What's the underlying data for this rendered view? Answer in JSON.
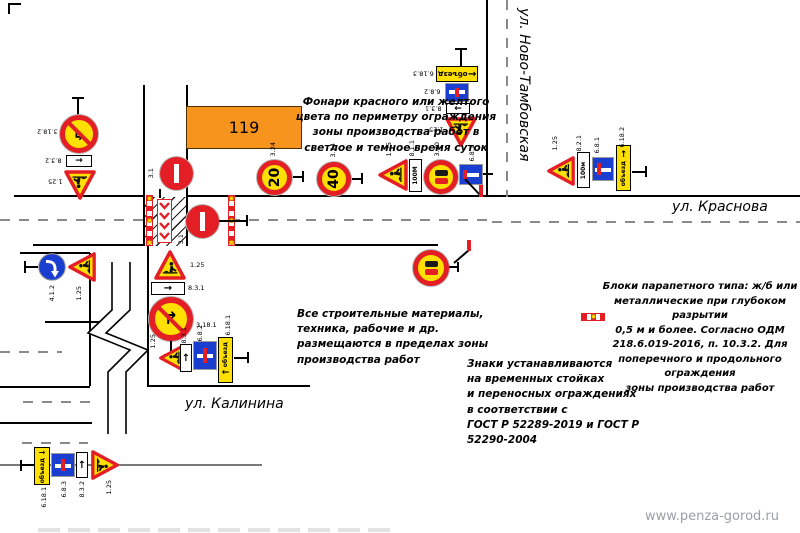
{
  "streets": {
    "vertical_right": "ул. Ново-Тамбовская",
    "horizontal_right": "ул. Краснова",
    "bottom_left": "ул. Калинина"
  },
  "building": {
    "label": "119"
  },
  "notes": {
    "lamps": "Фонари красного или желтого\nцвета по периметру ограждения\nзоны производства работ в\nсветлое и темное время суток",
    "materials": "Все строительные материалы,\nтехника, рабочие и др.\nразмещаются в пределах зоны\nпроизводства работ",
    "mounting": "Знаки устанавливаются\nна временных стойках\nи переносных ограждениях\nв соответствии с\nГОСТ Р 52289-2019 и ГОСТ Р\n52290-2004",
    "parapet": "Блоки парапетного типа: ж/б или\nметаллические при глубоком разрытии\n0,5 м и более. Согласно ОДМ\n218.6.019-2016, п. 10.3.2. Для\nпоперечного и продольного ограждения\nзоны производства работ"
  },
  "signs": {
    "speed20": "20",
    "speed40": "40",
    "dist_100m_upper": "100М",
    "dist_100m_lower": "100м",
    "detour_text": "объезд",
    "labels": {
      "g_topleft": [
        "3.18.2",
        "8.3.2",
        "1.25"
      ],
      "g_top": [
        "6.18.3",
        "6.8.2",
        "8.3.1",
        "1.25"
      ],
      "row": [
        "3.24",
        "3.24",
        "1.25",
        "8.1.1",
        "3.20",
        "6.8.1"
      ],
      "g_right": [
        "1.25",
        "8.2.1",
        "6.8.1",
        "6.18.2"
      ],
      "workzone": [
        "3.1",
        "3.1"
      ],
      "g_left": [
        "4.1.2",
        "1.25"
      ],
      "g_mid": [
        "1.25",
        "8.3.1",
        "3.18.1"
      ],
      "g_side": [
        "1.25",
        "8.3.1",
        "6.8.2",
        "6.18.1"
      ],
      "mid_overtake": "3.20",
      "g_bottom": [
        "6.18.1",
        "6.8.3",
        "8.3.2",
        "1.25"
      ]
    }
  },
  "glyphs": {
    "arrow_right": "→",
    "arrow_left": "←",
    "arrow_up": "↑",
    "turn_right_arrow": "↱",
    "turn_left_arrow": "↰"
  },
  "watermark": "www.penza-gorod.ru",
  "colors": {
    "building_orange": "#F7941E",
    "sign_yellow": "#FFE000",
    "sign_red": "#E31E24",
    "sign_blue": "#1A3FD0"
  }
}
